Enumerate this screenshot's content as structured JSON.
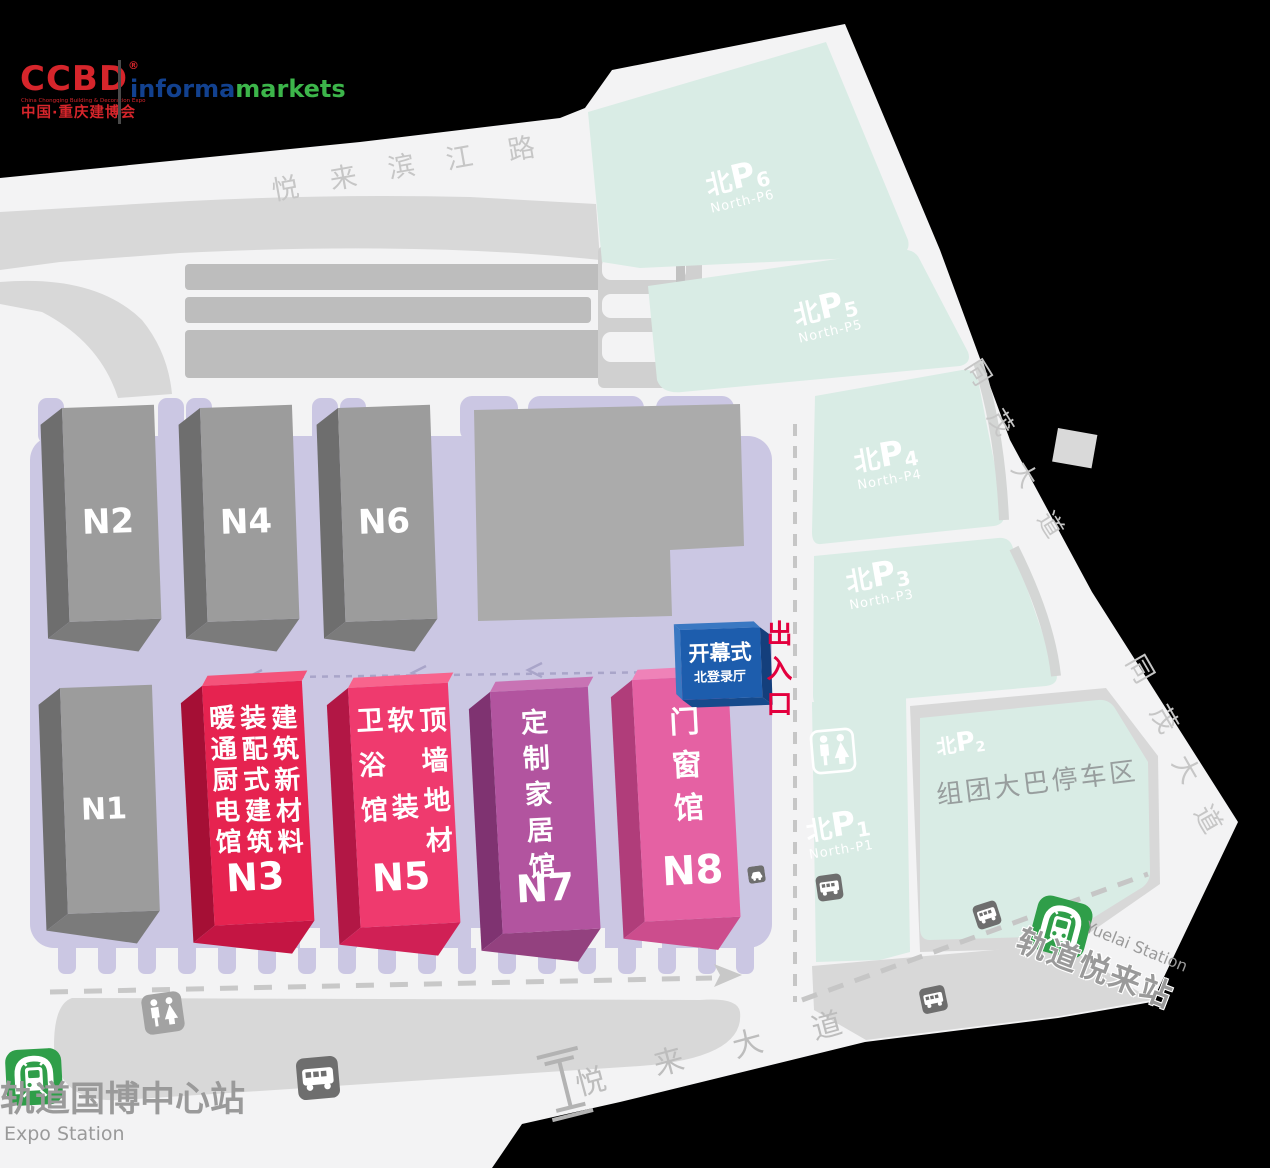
{
  "logo": {
    "ccbd": "CCBD",
    "reg_mark": "®",
    "ccbd_subtext": "China Chongqing Building & Decoration Expo",
    "ccbd_cn": "中国·重庆建博会",
    "informa": "informa",
    "markets": "markets",
    "ccbd_color": "#d6252b",
    "informa_color": "#12418f",
    "markets_color": "#3cb54a"
  },
  "roads": {
    "yuelai_binjiang_road": {
      "chars": [
        "悦",
        "来",
        "滨",
        "江",
        "路"
      ]
    },
    "tongmao_avenue_upper": {
      "chars": [
        "同",
        "茂",
        "大",
        "道"
      ]
    },
    "tongmao_avenue_lower": {
      "chars": [
        "同",
        "茂",
        "大",
        "道"
      ]
    },
    "yuelai_avenue": {
      "chars": [
        "悦",
        "来",
        "大",
        "道"
      ]
    }
  },
  "halls": {
    "n1": {
      "id": "N1",
      "color": "#9c9c9c"
    },
    "n2": {
      "id": "N2",
      "color": "#9c9c9c"
    },
    "n4": {
      "id": "N4",
      "color": "#9c9c9c"
    },
    "n6": {
      "id": "N6",
      "color": "#9c9c9c"
    },
    "n3": {
      "id": "N3",
      "columns": [
        "暖通厨电馆",
        "装配式建筑",
        "建筑新材料"
      ],
      "color": "#e62350"
    },
    "n5": {
      "id": "N5",
      "columns": [
        "卫浴馆",
        "软装",
        "顶墙地材"
      ],
      "color": "#ef3a6e"
    },
    "n7": {
      "id": "N7",
      "name": "定制家居馆",
      "color": "#b2549f"
    },
    "n8": {
      "id": "N8",
      "name": "门窗馆",
      "color": "#e561a3"
    }
  },
  "registration": {
    "title": "开幕式",
    "subtitle": "北登录厅",
    "color": "#1d5dad"
  },
  "entrance": {
    "label": "出入口",
    "color": "#e3003e"
  },
  "parking": {
    "area_color": "#d9ece5",
    "p6": {
      "cn": "北",
      "p": "P",
      "num": "6",
      "en": "North-P6"
    },
    "p5": {
      "cn": "北",
      "p": "P",
      "num": "5",
      "en": "North-P5"
    },
    "p4": {
      "cn": "北",
      "p": "P",
      "num": "4",
      "en": "North-P4"
    },
    "p3": {
      "cn": "北",
      "p": "P",
      "num": "3",
      "en": "North-P3"
    },
    "p2": {
      "cn": "北",
      "p": "P",
      "num": "2"
    },
    "p1": {
      "cn": "北",
      "p": "P",
      "num": "1",
      "en": "North-P1"
    }
  },
  "bus_parking_area": {
    "label": "组团大巴停车区"
  },
  "stations": {
    "metro_green": "#2f9e49",
    "expo": {
      "cn": "轨道国博中心站",
      "en": "Expo Station"
    },
    "yuelai": {
      "cn": "轨道悦来站",
      "en": "Yuelai Station"
    }
  },
  "plaza_color": "#cbc7e3"
}
